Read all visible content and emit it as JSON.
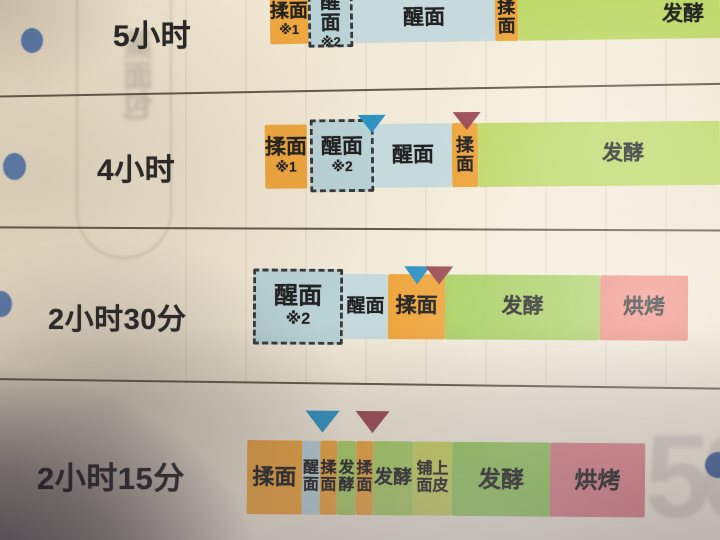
{
  "palette": {
    "orange": "#eea63e",
    "lightblue": "#b9d2d6",
    "lightblue_light": "#c6dadd",
    "green": "#a9cf62",
    "green_glare": "#c0d96b",
    "green_bright": "#98cb5f",
    "yellowgreen": "#c9d45c",
    "salmon": "#ee8b7d",
    "salmon2": "#dd8389",
    "marker_blue": "#2e93c4",
    "marker_red": "#9c4b55",
    "bullet": "#5a7bad",
    "ink": "#262626",
    "line": "#4a3f31",
    "paper": "#f0e7d4"
  },
  "page": {
    "watermark_number": "50",
    "show_through_glyphs": "蒸面包"
  },
  "rows": [
    {
      "name": "row-5-hours",
      "label": "5小时",
      "label_pos": {
        "x": 113,
        "y": 11,
        "size": 30
      },
      "bullet": {
        "x": 21,
        "y": 28,
        "w": 22,
        "h": 25
      },
      "bar": {
        "y": -5,
        "h": 48,
        "tilt": -0.8
      },
      "segments": [
        {
          "name": "knead",
          "label": "揉面",
          "sub": "※1",
          "color": "orange",
          "x": 270,
          "w": 38,
          "fs": 19,
          "subfs": 13
        },
        {
          "name": "rest",
          "label": "醒面",
          "sub": "※2",
          "color": "lightblue",
          "x": 308,
          "w": 45,
          "dashed": true,
          "dy": 0,
          "h": 52,
          "fs": 20,
          "subfs": 13
        },
        {
          "name": "rest",
          "label": "醒面",
          "color": "lightblue_light",
          "x": 353,
          "w": 142
        },
        {
          "name": "knead",
          "label": "揉面",
          "color": "orange",
          "x": 495,
          "w": 23,
          "vertical": true,
          "fs": 18
        },
        {
          "name": "ferment",
          "label": "发酵",
          "color": "green_glare",
          "x": 518,
          "w": 202,
          "text_right": 16
        }
      ],
      "markers": []
    },
    {
      "name": "row-4-hours",
      "label": "4小时",
      "label_pos": {
        "x": 97,
        "y": 145,
        "size": 30
      },
      "bullet": {
        "x": 3,
        "y": 153,
        "w": 23,
        "h": 27
      },
      "bar": {
        "y": 124,
        "h": 64,
        "tilt": -0.5
      },
      "segments": [
        {
          "name": "knead",
          "label": "揉面",
          "sub": "※1",
          "color": "orange",
          "x": 265,
          "w": 42
        },
        {
          "name": "rest",
          "label": "醒面",
          "sub": "※2",
          "color": "lightblue",
          "x": 310,
          "w": 64,
          "dashed": true,
          "dy": -5,
          "h": 73
        },
        {
          "name": "rest",
          "label": "醒面",
          "color": "lightblue_light",
          "x": 374,
          "w": 78
        },
        {
          "name": "knead",
          "label": "揉面",
          "color": "orange",
          "x": 452,
          "w": 26,
          "vertical": true,
          "fs": 18
        },
        {
          "name": "ferment",
          "label": "发酵",
          "color": "green_glare",
          "x": 478,
          "w": 242,
          "shift": 24
        }
      ],
      "markers": [
        {
          "name": "blue-triangle-marker",
          "color": "marker_blue",
          "x": 372,
          "dy": -9,
          "w": 28,
          "h": 18
        },
        {
          "name": "red-triangle-marker",
          "color": "marker_red",
          "x": 467,
          "dy": -11,
          "w": 28,
          "h": 18
        }
      ]
    },
    {
      "name": "row-2-hours-30-min",
      "label": "2小时30分",
      "label_pos": {
        "x": 48,
        "y": 296,
        "size": 29
      },
      "bullet": {
        "x": -10,
        "y": 291,
        "w": 22,
        "h": 26
      },
      "bar": {
        "y": 274,
        "h": 65,
        "tilt": 0.3
      },
      "segments": [
        {
          "name": "rest",
          "label": "醒面",
          "sub": "※2",
          "color": "lightblue",
          "x": 253,
          "w": 90,
          "dashed": true,
          "dy": -5,
          "h": 76,
          "big": true
        },
        {
          "name": "rest",
          "label": "醒面",
          "color": "lightblue_light",
          "x": 343,
          "w": 45,
          "small": true
        },
        {
          "name": "knead",
          "label": "揉面",
          "color": "orange",
          "x": 388,
          "w": 57
        },
        {
          "name": "ferment",
          "label": "发酵",
          "color": "green",
          "x": 445,
          "w": 155
        },
        {
          "name": "bake",
          "label": "烘烤",
          "color": "salmon",
          "x": 600,
          "w": 88
        }
      ],
      "markers": [
        {
          "name": "blue-triangle-marker",
          "color": "marker_blue",
          "x": 417,
          "dy": -8,
          "w": 26,
          "h": 18
        },
        {
          "name": "red-triangle-marker",
          "color": "marker_red",
          "x": 439,
          "dy": -8,
          "w": 28,
          "h": 18
        }
      ]
    },
    {
      "name": "row-2-hours-15-min",
      "label": "2小时15分",
      "label_pos": {
        "x": 37,
        "y": 453,
        "size": 31
      },
      "bullet": null,
      "bar": {
        "y": 441,
        "h": 74,
        "tilt": 0.5
      },
      "segments": [
        {
          "name": "knead",
          "label": "揉面",
          "color": "orange",
          "x": 247,
          "w": 55,
          "fs": 22
        },
        {
          "name": "rest",
          "label": "醒面",
          "color": "lightblue",
          "x": 302,
          "w": 18,
          "vertical": true,
          "fs": 16
        },
        {
          "name": "knead",
          "label": "揉面",
          "color": "orange",
          "x": 320,
          "w": 17,
          "vertical": true,
          "fs": 16
        },
        {
          "name": "ferment",
          "label": "发酵",
          "color": "green",
          "x": 337,
          "w": 19,
          "vertical": true,
          "fs": 16
        },
        {
          "name": "knead",
          "label": "揉面",
          "color": "orange",
          "x": 356,
          "w": 17,
          "vertical": true,
          "fs": 16
        },
        {
          "name": "ferment",
          "label": "发酵",
          "color": "green",
          "x": 373,
          "w": 40,
          "small": true
        },
        {
          "name": "lay-dough-skin",
          "label": "铺上面皮",
          "lines": [
            "铺上",
            "面皮"
          ],
          "color": "yellowgreen",
          "x": 413,
          "w": 39,
          "fs": 16
        },
        {
          "name": "ferment",
          "label": "发酵",
          "color": "green_bright",
          "x": 452,
          "w": 98,
          "fs": 23
        },
        {
          "name": "bake",
          "label": "烘烤",
          "color": "salmon2",
          "x": 550,
          "w": 95,
          "fs": 23
        }
      ],
      "markers": [
        {
          "name": "blue-triangle-marker",
          "color": "marker_blue",
          "x": 322,
          "dy": -30,
          "w": 34,
          "h": 22
        },
        {
          "name": "red-triangle-marker",
          "color": "marker_red",
          "x": 372,
          "dy": -30,
          "w": 34,
          "h": 22
        }
      ]
    }
  ]
}
